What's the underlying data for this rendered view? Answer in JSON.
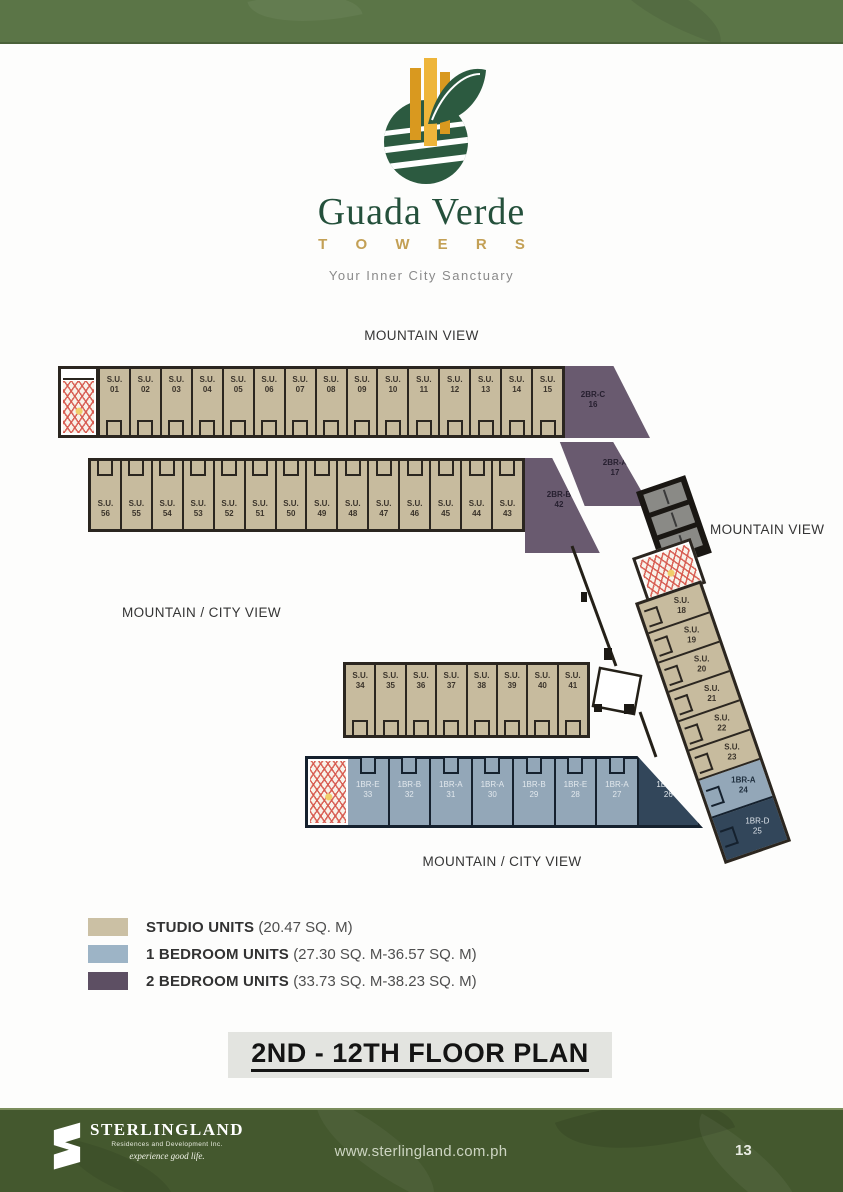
{
  "brand": {
    "title": "Guada Verde",
    "subtitle": "T O W E R S",
    "tagline": "Your Inner City Sanctuary"
  },
  "view_labels": {
    "top": "MOUNTAIN VIEW",
    "right": "MOUNTAIN VIEW",
    "left": "MOUNTAIN / CITY VIEW",
    "bottom": "MOUNTAIN / CITY VIEW"
  },
  "units": {
    "row_top": [
      {
        "t": "S.U.",
        "n": "01"
      },
      {
        "t": "S.U.",
        "n": "02"
      },
      {
        "t": "S.U.",
        "n": "03"
      },
      {
        "t": "S.U.",
        "n": "04"
      },
      {
        "t": "S.U.",
        "n": "05"
      },
      {
        "t": "S.U.",
        "n": "06"
      },
      {
        "t": "S.U.",
        "n": "07"
      },
      {
        "t": "S.U.",
        "n": "08"
      },
      {
        "t": "S.U.",
        "n": "09"
      },
      {
        "t": "S.U.",
        "n": "10"
      },
      {
        "t": "S.U.",
        "n": "11"
      },
      {
        "t": "S.U.",
        "n": "12"
      },
      {
        "t": "S.U.",
        "n": "13"
      },
      {
        "t": "S.U.",
        "n": "14"
      },
      {
        "t": "S.U.",
        "n": "15"
      }
    ],
    "row_second": [
      {
        "t": "S.U.",
        "n": "56"
      },
      {
        "t": "S.U.",
        "n": "55"
      },
      {
        "t": "S.U.",
        "n": "54"
      },
      {
        "t": "S.U.",
        "n": "53"
      },
      {
        "t": "S.U.",
        "n": "52"
      },
      {
        "t": "S.U.",
        "n": "51"
      },
      {
        "t": "S.U.",
        "n": "50"
      },
      {
        "t": "S.U.",
        "n": "49"
      },
      {
        "t": "S.U.",
        "n": "48"
      },
      {
        "t": "S.U.",
        "n": "47"
      },
      {
        "t": "S.U.",
        "n": "46"
      },
      {
        "t": "S.U.",
        "n": "45"
      },
      {
        "t": "S.U.",
        "n": "44"
      },
      {
        "t": "S.U.",
        "n": "43"
      }
    ],
    "purple": {
      "c16": {
        "t": "2BR-C",
        "n": "16"
      },
      "a17": {
        "t": "2BR-A",
        "n": "17"
      },
      "b42": {
        "t": "2BR-B",
        "n": "42"
      }
    },
    "wing_right": [
      {
        "t": "S.U.",
        "n": "18",
        "v": "su"
      },
      {
        "t": "S.U.",
        "n": "19",
        "v": "su"
      },
      {
        "t": "S.U.",
        "n": "20",
        "v": "su"
      },
      {
        "t": "S.U.",
        "n": "21",
        "v": "su"
      },
      {
        "t": "S.U.",
        "n": "22",
        "v": "su"
      },
      {
        "t": "S.U.",
        "n": "23",
        "v": "su"
      },
      {
        "t": "1BR-A",
        "n": "24",
        "v": "blue"
      },
      {
        "t": "1BR-D",
        "n": "25",
        "v": "blue-dark"
      }
    ],
    "row_mid": [
      {
        "t": "S.U.",
        "n": "34"
      },
      {
        "t": "S.U.",
        "n": "35"
      },
      {
        "t": "S.U.",
        "n": "36"
      },
      {
        "t": "S.U.",
        "n": "37"
      },
      {
        "t": "S.U.",
        "n": "38"
      },
      {
        "t": "S.U.",
        "n": "39"
      },
      {
        "t": "S.U.",
        "n": "40"
      },
      {
        "t": "S.U.",
        "n": "41"
      }
    ],
    "row_bottom": [
      {
        "t": "1BR-E",
        "n": "33",
        "v": "blue"
      },
      {
        "t": "1BR-B",
        "n": "32",
        "v": "blue"
      },
      {
        "t": "1BR-A",
        "n": "31",
        "v": "blue"
      },
      {
        "t": "1BR-A",
        "n": "30",
        "v": "blue"
      },
      {
        "t": "1BR-B",
        "n": "29",
        "v": "blue"
      },
      {
        "t": "1BR-E",
        "n": "28",
        "v": "blue"
      },
      {
        "t": "1BR-A",
        "n": "27",
        "v": "blue"
      },
      {
        "t": "1BR-C",
        "n": "26",
        "v": "blue-dark",
        "w": 1.5
      }
    ]
  },
  "legend": {
    "items": [
      {
        "label": "STUDIO UNITS",
        "detail": "(20.47 SQ. M)",
        "swatch": "#cbc0a4"
      },
      {
        "label": "1 BEDROOM UNITS",
        "detail": "(27.30 SQ. M-36.57 SQ. M)",
        "swatch": "#9db4c6"
      },
      {
        "label": "2 BEDROOM UNITS",
        "detail": "(33.73 SQ. M-38.23 SQ. M)",
        "swatch": "#5d4f63"
      }
    ]
  },
  "floor_title": "2ND - 12TH  FLOOR PLAN",
  "footer": {
    "brand": "STERLINGLAND",
    "brand_line2": "Residences and Development Inc.",
    "brand_tagline": "experience good life.",
    "website": "www.sterlingland.com.ph",
    "page_number": "13"
  },
  "colors": {
    "studio_fill": "#c7bb9e",
    "one_bedroom_fill": "#8a9dae",
    "one_bedroom_dark_fill": "#32465a",
    "two_bedroom_fill": "#695a6f",
    "wall": "#2b2620",
    "accent_green": "#5b7547",
    "footer_green": "#44582e",
    "gold": "#c3a055"
  }
}
